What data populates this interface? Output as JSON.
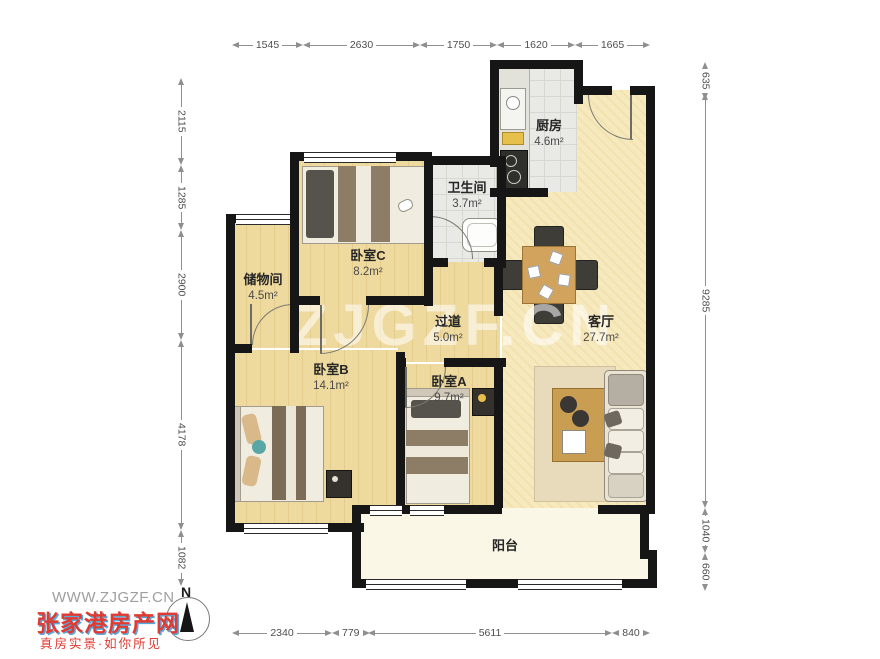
{
  "watermark": {
    "url": "WWW.ZJGZF.CN",
    "site": "张家港房产网",
    "slogan": "真房实景·如你所见",
    "north": "N",
    "faint": "ZJGZF.CN"
  },
  "dimensions": {
    "top": [
      "1545",
      "2630",
      "1750",
      "1620",
      "1665"
    ],
    "left": [
      "2115",
      "1285",
      "2900",
      "4178",
      "1082"
    ],
    "right": [
      "635",
      "9285",
      "1040",
      "660"
    ],
    "bottom": [
      "2340",
      "779",
      "5611",
      "840"
    ]
  },
  "rooms": {
    "kitchen": {
      "name": "厨房",
      "area": "4.6m²"
    },
    "bathroom": {
      "name": "卫生间",
      "area": "3.7m²"
    },
    "bedroom_c": {
      "name": "卧室C",
      "area": "8.2m²"
    },
    "storage": {
      "name": "储物间",
      "area": "4.5m²"
    },
    "hallway": {
      "name": "过道",
      "area": "5.0m²"
    },
    "living": {
      "name": "客厅",
      "area": "27.7m²"
    },
    "bedroom_b": {
      "name": "卧室B",
      "area": "14.1m²"
    },
    "bedroom_a": {
      "name": "卧室A",
      "area": "9.7m²"
    },
    "balcony": {
      "name": "阳台"
    }
  },
  "colors": {
    "wall": "#161616",
    "wood_floor": "#eeda9f",
    "living_floor": "#f6e9bd",
    "tile_floor": "#e9e9e5",
    "balcony_floor": "#faf7e6",
    "brand_red": "#e03a32",
    "brand_blue": "#58a8d8"
  }
}
